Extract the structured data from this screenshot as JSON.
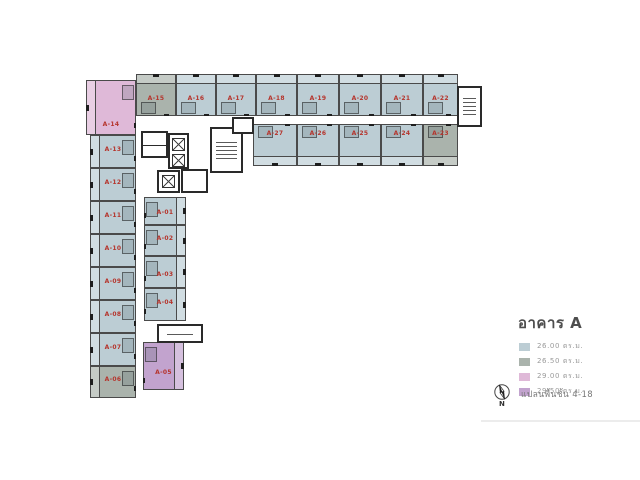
{
  "legend": {
    "title": "อาคาร A",
    "items": [
      {
        "area": "26.00 ตร.ม.",
        "color": "#bccdd4",
        "type": "blue"
      },
      {
        "area": "26.50 ตร.ม.",
        "color": "#aab3ac",
        "type": "gray"
      },
      {
        "area": "29.00 ตร.ม.",
        "color": "#dfb9d8",
        "type": "pink"
      },
      {
        "area": "29.50 ตร.ม.",
        "color": "#c2a3ce",
        "type": "purple"
      }
    ],
    "compass_label": "N",
    "note": "แปลนพื้นชั้น 4-18"
  },
  "plan": {
    "unit_label_color": "#b5342c",
    "wall_color": "#4a4a4a",
    "types": {
      "blue": "#bccdd4",
      "gray": "#aab3ac",
      "pink": "#dfb9d8",
      "purple": "#c2a3ce"
    },
    "units": [
      {
        "id": "A-14",
        "t": "pink",
        "x": 86,
        "y": 80,
        "w": 50,
        "h": 55,
        "b": "l",
        "c": "r",
        "lf": 0.8
      },
      {
        "id": "A-13",
        "t": "blue",
        "x": 90,
        "y": 135,
        "w": 46,
        "h": 33,
        "b": "l",
        "c": "r",
        "lf": 0.42
      },
      {
        "id": "A-12",
        "t": "blue",
        "x": 90,
        "y": 168,
        "w": 46,
        "h": 33,
        "b": "l",
        "c": "r",
        "lf": 0.42
      },
      {
        "id": "A-11",
        "t": "blue",
        "x": 90,
        "y": 201,
        "w": 46,
        "h": 33,
        "b": "l",
        "c": "r",
        "lf": 0.42
      },
      {
        "id": "A-10",
        "t": "blue",
        "x": 90,
        "y": 234,
        "w": 46,
        "h": 33,
        "b": "l",
        "c": "r",
        "lf": 0.42
      },
      {
        "id": "A-09",
        "t": "blue",
        "x": 90,
        "y": 267,
        "w": 46,
        "h": 33,
        "b": "l",
        "c": "r",
        "lf": 0.42
      },
      {
        "id": "A-08",
        "t": "blue",
        "x": 90,
        "y": 300,
        "w": 46,
        "h": 33,
        "b": "l",
        "c": "r",
        "lf": 0.42
      },
      {
        "id": "A-07",
        "t": "blue",
        "x": 90,
        "y": 333,
        "w": 46,
        "h": 33,
        "b": "l",
        "c": "r",
        "lf": 0.42
      },
      {
        "id": "A-06",
        "t": "gray",
        "x": 90,
        "y": 366,
        "w": 46,
        "h": 32,
        "b": "l",
        "c": "r",
        "lf": 0.42
      },
      {
        "id": "A-01",
        "t": "blue",
        "x": 144,
        "y": 197,
        "w": 42,
        "h": 28,
        "b": "r",
        "c": "l",
        "lf": 0.55
      },
      {
        "id": "A-02",
        "t": "blue",
        "x": 144,
        "y": 225,
        "w": 42,
        "h": 31,
        "b": "r",
        "c": "l",
        "lf": 0.42
      },
      {
        "id": "A-03",
        "t": "blue",
        "x": 144,
        "y": 256,
        "w": 42,
        "h": 32,
        "b": "r",
        "c": "l",
        "lf": 0.55
      },
      {
        "id": "A-04",
        "t": "blue",
        "x": 144,
        "y": 288,
        "w": 42,
        "h": 33,
        "b": "r",
        "c": "l",
        "lf": 0.42
      },
      {
        "id": "A-05",
        "t": "purple",
        "x": 143,
        "y": 342,
        "w": 41,
        "h": 48,
        "b": "r",
        "c": "l",
        "lf": 0.62
      },
      {
        "id": "A-15",
        "t": "gray",
        "x": 136,
        "y": 74,
        "w": 40,
        "h": 42,
        "b": "t",
        "c": "b",
        "lf": 0.56
      },
      {
        "id": "A-16",
        "t": "blue",
        "x": 176,
        "y": 74,
        "w": 40,
        "h": 42,
        "b": "t",
        "c": "b",
        "lf": 0.56
      },
      {
        "id": "A-17",
        "t": "blue",
        "x": 216,
        "y": 74,
        "w": 40,
        "h": 42,
        "b": "t",
        "c": "b",
        "lf": 0.56
      },
      {
        "id": "A-18",
        "t": "blue",
        "x": 256,
        "y": 74,
        "w": 41,
        "h": 42,
        "b": "t",
        "c": "b",
        "lf": 0.56
      },
      {
        "id": "A-19",
        "t": "blue",
        "x": 297,
        "y": 74,
        "w": 42,
        "h": 42,
        "b": "t",
        "c": "b",
        "lf": 0.56
      },
      {
        "id": "A-20",
        "t": "blue",
        "x": 339,
        "y": 74,
        "w": 42,
        "h": 42,
        "b": "t",
        "c": "b",
        "lf": 0.56
      },
      {
        "id": "A-21",
        "t": "blue",
        "x": 381,
        "y": 74,
        "w": 42,
        "h": 42,
        "b": "t",
        "c": "b",
        "lf": 0.56
      },
      {
        "id": "A-22",
        "t": "blue",
        "x": 423,
        "y": 74,
        "w": 35,
        "h": 42,
        "b": "t",
        "c": "b",
        "lf": 0.56
      },
      {
        "id": "A-27",
        "t": "blue",
        "x": 253,
        "y": 124,
        "w": 44,
        "h": 42,
        "b": "b",
        "c": "t",
        "lf": 0.22
      },
      {
        "id": "A-26",
        "t": "blue",
        "x": 297,
        "y": 124,
        "w": 42,
        "h": 42,
        "b": "b",
        "c": "t",
        "lf": 0.22
      },
      {
        "id": "A-25",
        "t": "blue",
        "x": 339,
        "y": 124,
        "w": 42,
        "h": 42,
        "b": "b",
        "c": "t",
        "lf": 0.22
      },
      {
        "id": "A-24",
        "t": "blue",
        "x": 381,
        "y": 124,
        "w": 42,
        "h": 42,
        "b": "b",
        "c": "t",
        "lf": 0.22
      },
      {
        "id": "A-23",
        "t": "gray",
        "x": 423,
        "y": 124,
        "w": 35,
        "h": 42,
        "b": "b",
        "c": "t",
        "lf": 0.22
      }
    ],
    "core_rooms": [
      {
        "name": "service-rooms",
        "x": 141,
        "y": 131,
        "w": 27,
        "h": 27,
        "kind": "rooms2"
      },
      {
        "name": "elevator-bank",
        "x": 168,
        "y": 133,
        "w": 21,
        "h": 36,
        "kind": "lift2"
      },
      {
        "name": "elevator-single",
        "x": 157,
        "y": 170,
        "w": 23,
        "h": 23,
        "kind": "lift1"
      },
      {
        "name": "service-room-east",
        "x": 181,
        "y": 169,
        "w": 27,
        "h": 24,
        "kind": "room"
      },
      {
        "name": "stairwell-main",
        "x": 210,
        "y": 127,
        "w": 33,
        "h": 46,
        "kind": "stair"
      },
      {
        "name": "store-room",
        "x": 232,
        "y": 117,
        "w": 22,
        "h": 17,
        "kind": "room"
      },
      {
        "name": "stairwell-east-end",
        "x": 457,
        "y": 86,
        "w": 25,
        "h": 41,
        "kind": "stair"
      },
      {
        "name": "mail-room",
        "x": 157,
        "y": 324,
        "w": 46,
        "h": 19,
        "kind": "mail"
      }
    ]
  }
}
